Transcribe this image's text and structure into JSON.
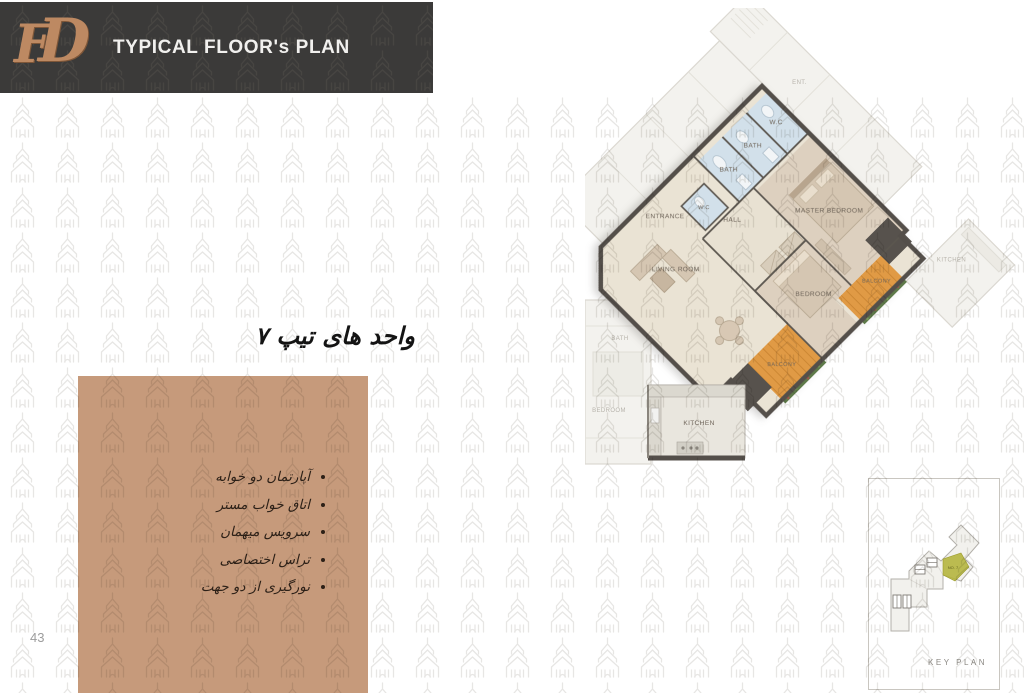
{
  "header": {
    "logo": "FD",
    "title": "TYPICAL FLOOR's PLAN"
  },
  "section": {
    "heading": "واحد های تیپ ۷"
  },
  "features": {
    "items": [
      "آپارتمان دو خوابه",
      "اتاق خواب مستر",
      "سرویس میهمان",
      "تراس اختصاصی",
      "نورگیری از دو جهت"
    ]
  },
  "plan": {
    "labels": {
      "entrance": "ENTRANCE",
      "wc_top": "W.C",
      "bath1": "BATH",
      "bath2": "BATH",
      "wc_guest": "W.C",
      "hall": "HALL",
      "master": "MASTER BEDROOM",
      "bedroom": "BEDROOM",
      "living": "LIVING ROOM",
      "kitchen": "KITCHEN",
      "balcony1": "BALCONY",
      "balcony2": "BALCONY",
      "adj_ent": "ENT.",
      "adj_kitchen": "KITCHEN",
      "adj_bedroom": "BEDROOM",
      "adj_bath": "BATH"
    }
  },
  "key_plan": {
    "label": "KEY PLAN",
    "unit": "NO. 7"
  },
  "page": {
    "number": "43"
  },
  "colors": {
    "header_bar": "#3b3a39",
    "logo_copper": "#bd8962",
    "panel_bg": "#c69a7b",
    "balcony_orange": "#e09a45",
    "wall_gray": "#544f4a",
    "key_highlight": "#b1b134",
    "watermark_gray": "#e9e9e9"
  }
}
